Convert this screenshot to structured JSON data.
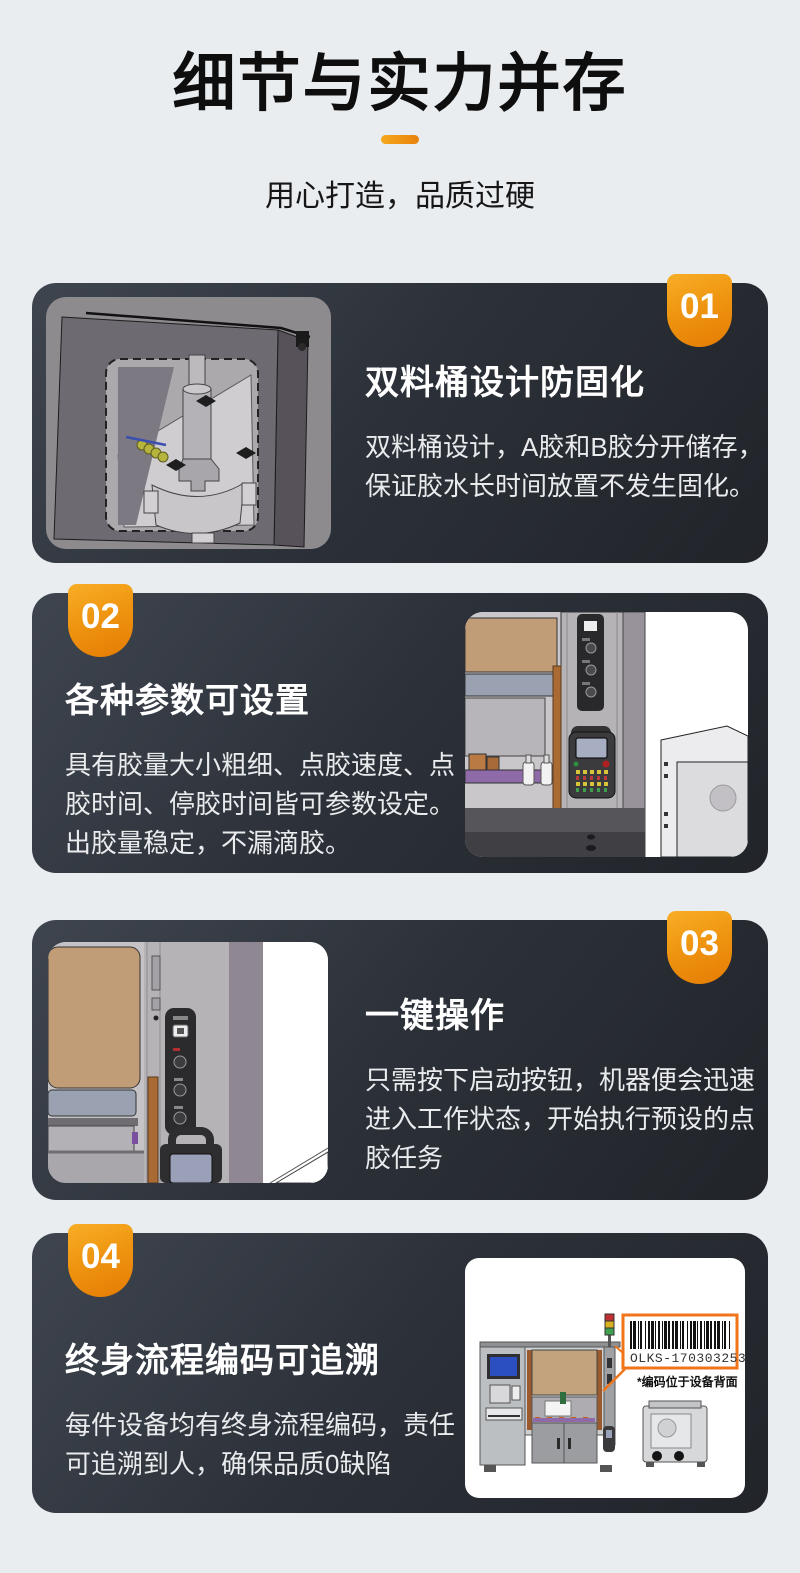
{
  "page": {
    "background": "#e9edf0",
    "card_background": "#2c3139",
    "accent_orange": "#ef8a0c",
    "text_on_dark": "#e9ebed"
  },
  "header": {
    "title": "细节与实力并存",
    "subtitle": "用心打造，品质过硬"
  },
  "cards": [
    {
      "num": "01",
      "title": "双料桶设计防固化",
      "body": "双料桶设计，A胶和B胶分开储存，保证胶水长时间放置不发生固化。",
      "image": "dual-barrel-cad-render"
    },
    {
      "num": "02",
      "title": "各种参数可设置",
      "body": "具有胶量大小粗细、点胶速度、点胶时间、停胶时间皆可参数设定。出胶量稳定，不漏滴胶。",
      "image": "teach-pendant-cad-render"
    },
    {
      "num": "03",
      "title": "一键操作",
      "body": "只需按下启动按钮，机器便会迅速进入工作状态，开始执行预设的点胶任务",
      "image": "start-button-panel-cad-render"
    },
    {
      "num": "04",
      "title": "终身流程编码可追溯",
      "body": "每件设备均有终身流程编码，责任可追溯到人，确保品质0缺陷",
      "image": "machine-with-barcode-render",
      "barcode_text": "OLKS-1703032539",
      "barcode_note": "*编码位于设备背面"
    }
  ]
}
